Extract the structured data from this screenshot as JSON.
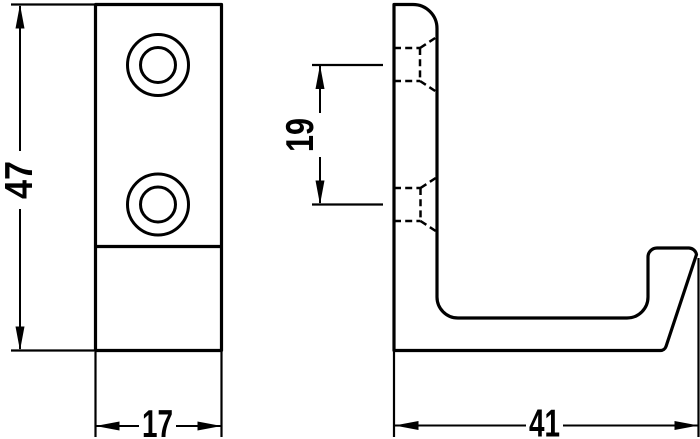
{
  "drawing": {
    "kind": "technical-dimension-drawing",
    "subject": "wall-hook-two-views",
    "background_color": "#ffffff",
    "line_color": "#000000",
    "views": {
      "front_view": "plate-with-two-countersunk-holes",
      "side_view": "j-shaped-hook-profile-with-hidden-hole-lines"
    },
    "dimensions": {
      "height": "47",
      "width": "17",
      "hole_spacing": "19",
      "depth": "41"
    }
  }
}
